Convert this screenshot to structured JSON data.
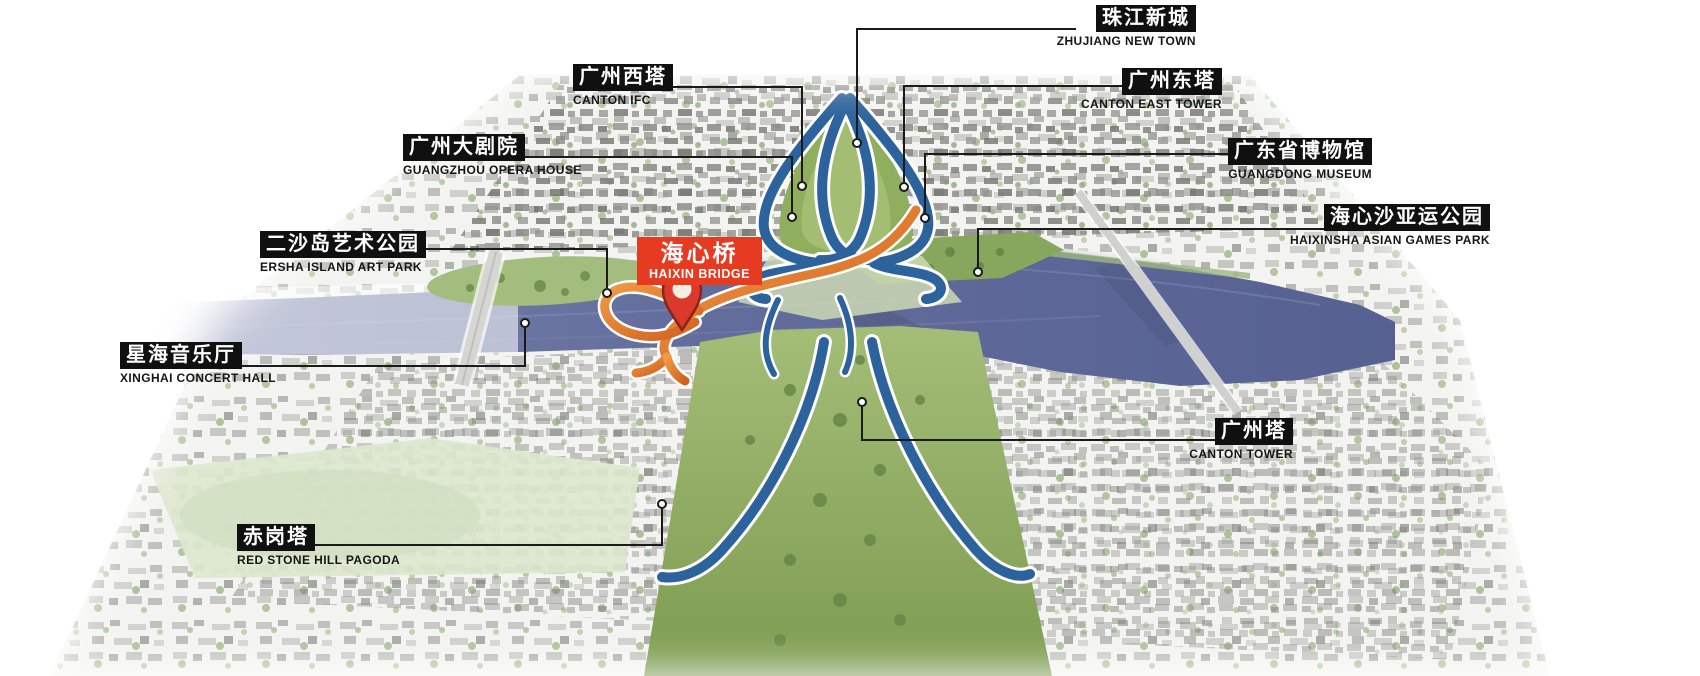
{
  "map": {
    "subject": "Haixin Bridge pedestrian bridge location, Pearl River, Guangzhou",
    "view": "aerial perspective plan"
  },
  "highlight": {
    "cn": "海心桥",
    "en": "HAIXIN BRIDGE"
  },
  "landmarks": [
    {
      "cn": "珠江新城",
      "en": "ZHUJIANG NEW TOWN"
    },
    {
      "cn": "广州西塔",
      "en": "CANTON IFC"
    },
    {
      "cn": "广州东塔",
      "en": "CANTON EAST TOWER"
    },
    {
      "cn": "广州大剧院",
      "en": "GUANGZHOU OPERA HOUSE"
    },
    {
      "cn": "广东省博物馆",
      "en": "GUANGDONG MUSEUM"
    },
    {
      "cn": "二沙岛艺术公园",
      "en": "ERSHA ISLAND ART PARK"
    },
    {
      "cn": "海心沙亚运公园",
      "en": "HAIXINSHA ASIAN GAMES PARK"
    },
    {
      "cn": "星海音乐厅",
      "en": "XINGHAI CONCERT HALL"
    },
    {
      "cn": "广州塔",
      "en": "CANTON TOWER"
    },
    {
      "cn": "赤岗塔",
      "en": "RED STONE HILL PAGODA"
    }
  ],
  "colors": {
    "label_bg": "#101010",
    "label_text": "#ffffff",
    "sublabel_text": "#161616",
    "highlight_bg": "#e63b21",
    "river": "#616c9b",
    "route_blue": "#2c639c",
    "route_orange": "#e2702f",
    "park_green": "#8fae5e",
    "pin_red": "#d93a2b",
    "leader_line": "#1a1a1a"
  },
  "icons": {
    "pin": "location-pin-icon",
    "leader_dot": "leader-endpoint-dot"
  }
}
